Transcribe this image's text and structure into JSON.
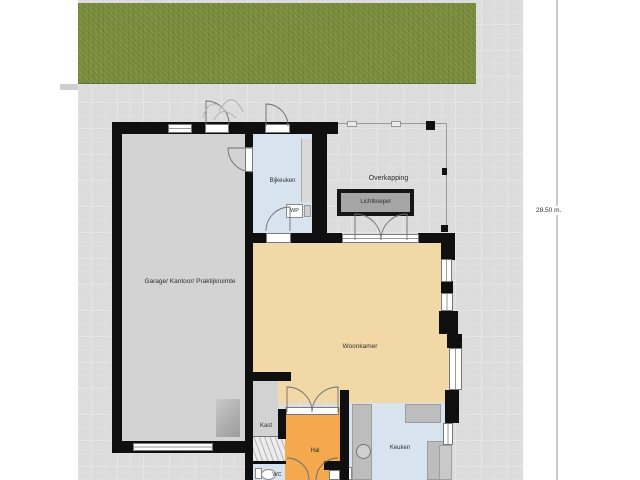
{
  "plan": {
    "rooms": {
      "garage": "Garage/ Kantoor/ Praktijkruimte",
      "bijkeuken": "Bijkeuken",
      "woonkamer": "Woonkamer",
      "kast": "Kast",
      "hal": "Hal",
      "wc": "WC",
      "keuken": "Keuken"
    },
    "outdoor": {
      "overkapping": "Overkapping",
      "lichtkoepel": "Lichtkoepel"
    },
    "equipment": {
      "wp": "WP",
      "mv": "MV"
    },
    "dimension": "28.50 m.",
    "colors": {
      "grass": "#7c8e3d",
      "paving": "#dcdcdc",
      "wall": "#0f0f0f",
      "woonkamer_tan": "#f2d8a6",
      "hal_orange": "#f5a94e",
      "wet_room_blue": "#d7e4f0",
      "garage_gray": "#d3d3d3",
      "counter_gray": "#bdbdbd",
      "lichtkoepel_gray": "#a6a6a6"
    }
  }
}
